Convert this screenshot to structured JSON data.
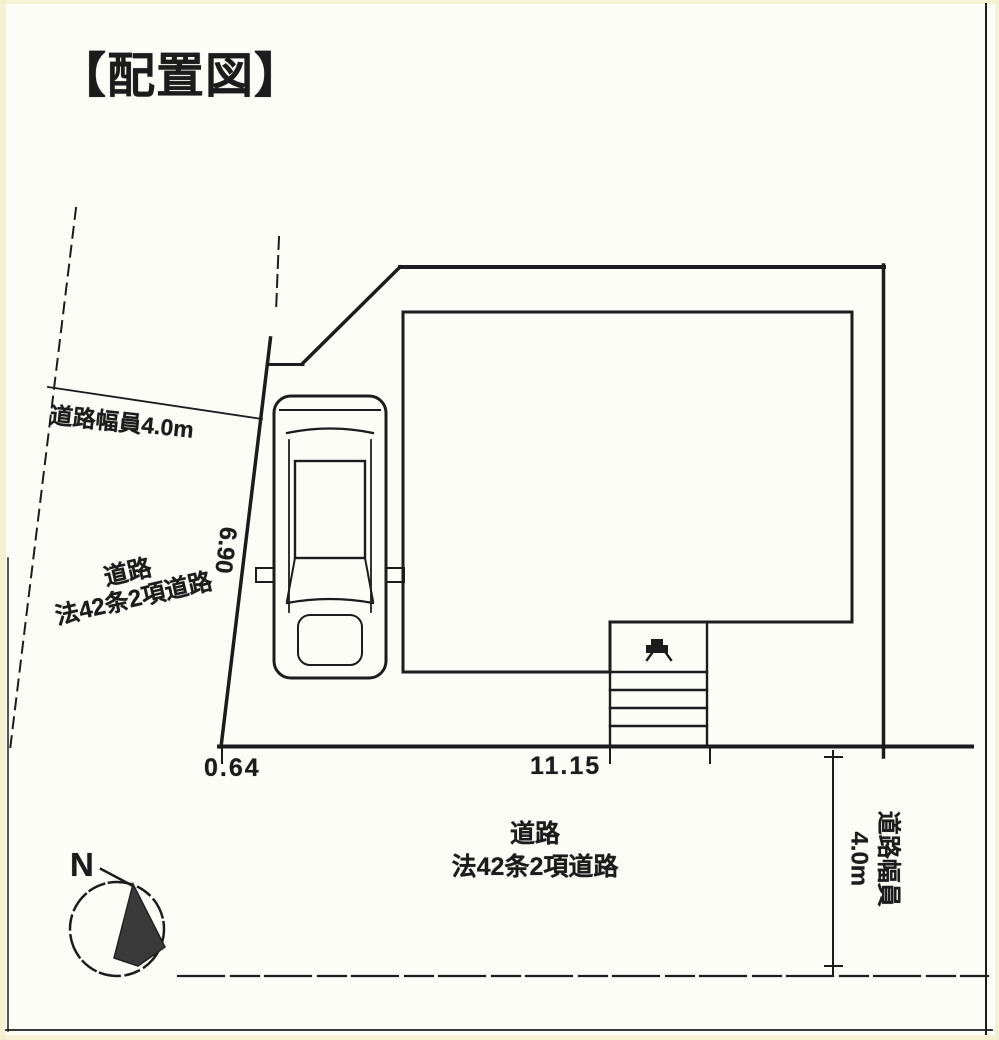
{
  "page": {
    "title": "【配置図】"
  },
  "site_plan": {
    "left_road": {
      "width_label": "道路幅員4.0m",
      "name_line1": "道路",
      "name_line2": "法42条2項道路"
    },
    "bottom_road": {
      "name_line1": "道路",
      "name_line2": "法42条2項道路",
      "width_label_line1": "道路幅員",
      "width_label_line2": "4.0m"
    },
    "dimensions": {
      "parking_depth": "6.90",
      "offset": "0.64",
      "frontage": "11.15"
    },
    "compass": {
      "north_label": "N"
    }
  },
  "colors": {
    "ink": "#1c1c1c",
    "paper": "#fdfdf8",
    "edge_tint": "#f4eec9"
  }
}
